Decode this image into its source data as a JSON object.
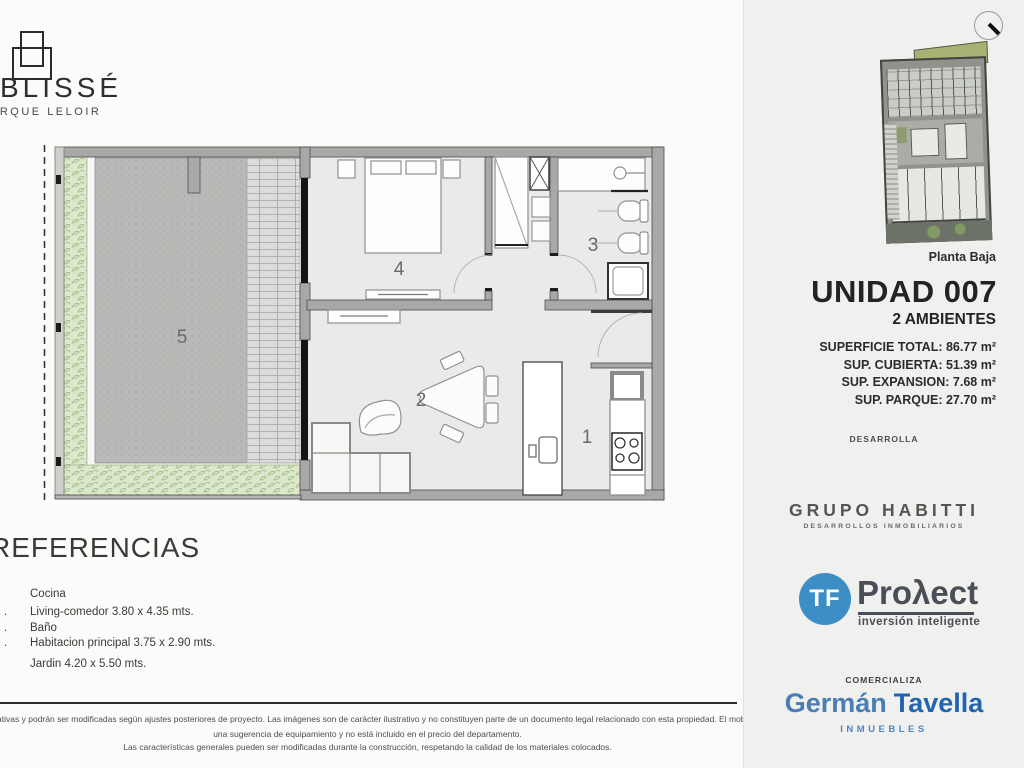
{
  "brand": {
    "name": "BLISSÉ",
    "subtitle": "PARQUE LELOIR"
  },
  "plan": {
    "rooms": [
      "5",
      "4",
      "3",
      "2",
      "1"
    ]
  },
  "references": {
    "title": "REFERENCIAS",
    "items": [
      "Cocina",
      "Living-comedor 3.80 x 4.35 mts.",
      "Baño",
      "Habitacion principal 3.75 x 2.90 mts.",
      "Jardin 4.20 x 5.50 mts."
    ]
  },
  "disclaimer": {
    "line1": "Las medidas son indicativas y podrán ser modificadas según ajustes posteriores de proyecto. Las imágenes son de carácter ilustrativo y no constituyen parte de un documento legal relacionado con esta propiedad. El mobiliario corresponde a",
    "line2": "una sugerencia de equipamiento y no está incluido en el precio del departamento.",
    "line3": "Las características generales pueden ser modificadas durante la construcción, respetando la calidad de los materiales colocados."
  },
  "sidebar": {
    "thumbnail_caption": "Planta Baja",
    "unit": {
      "title": "UNIDAD 007",
      "subtitle": "2 AMBIENTES",
      "surfaces": [
        "SUPERFICIE TOTAL: 86.77 m²",
        "SUP. CUBIERTA: 51.39 m²",
        "SUP. EXPANSION: 7.68 m²",
        "SUP. PARQUE: 27.70 m²"
      ]
    },
    "developer": {
      "heading": "DESARROLLA",
      "name": "GRUPO HABITTI",
      "tagline": "DESARROLLOS INMOBILIARIOS"
    },
    "partner": {
      "badge": "TF",
      "name": "Proλect",
      "tagline": "inversión inteligente"
    },
    "broker": {
      "heading": "COMERCIALIZA",
      "first": "Germán",
      "last": "Tavella",
      "tagline": "INMUEBLES"
    }
  },
  "colors": {
    "tf_blue": "#3c8ec5",
    "tavella_dark_blue": "#2264ad",
    "tavella_light_blue": "#4a7db3",
    "roof_olive": "#a9b173",
    "hatch_green": "#9dbb83"
  }
}
